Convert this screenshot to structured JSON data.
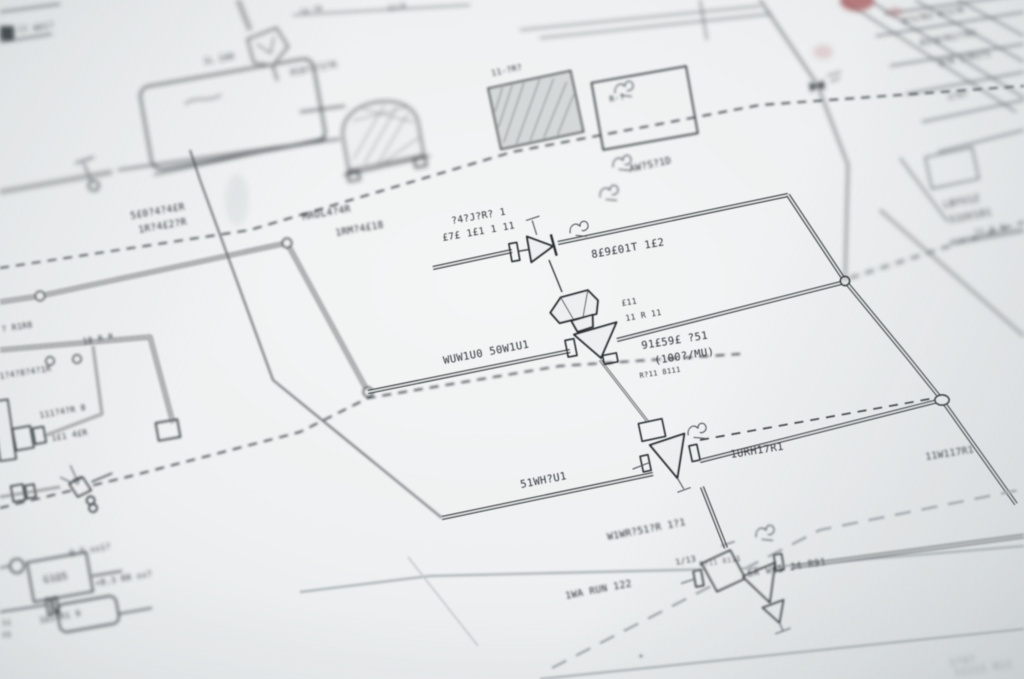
{
  "scene": {
    "description": "Close-up photograph of a paper engineering schematic (P&ID style blueprint) at a tilted angle with shallow depth of field; center valves in focus, edges blurred",
    "paper_color": "#edeff0",
    "ink_color": "#2c3034",
    "sheet_border_color": "#b3b9bb",
    "dashed_line_color": "#3b4044",
    "gray_dashed_color": "#a7adb0",
    "stamp_color": "#a86062"
  },
  "labels": [
    "1.11",
    "WH1?",
    "?4·?R",
    "11/4",
    "1L 2AR",
    "810?4?2?R",
    "11-?R?",
    "R·?",
    "AW?S?1D",
    "5£0?4?4£R",
    "1R?4£2?R",
    "MROL4?4R",
    "1RM?4£18",
    "?4?J?R? 1",
    "£7£ 1£1 1 11",
    "8£9£01T 1£2",
    "£11",
    "11 R 11",
    "WUW1U0 50W1U1",
    "91£59£ ?51",
    "(100?/MU)",
    "1URH17R1",
    "51WH?U1",
    "W1WR?51?R 1?1",
    "1/13",
    "1WA RUN 122",
    "5A W65 J4 R91",
    "11W117R1",
    "LBYV1Z",
    "51UV101",
    "?1 8.8",
    "10 R R",
    "? R1R8",
    "1?4?8?4?1R",
    "111?4?R 8",
    "1£1 4£R",
    "Q.T xx1?",
    "+8.3 RR xx?",
    "1Ω14R1 9",
    "G1Ω5",
    "11",
    "15",
    "8?1?R1 R?1?R",
    "R1?8?R1??R1",
    "8?R 1?R1?1",
    "1?4?",
    "11111 811",
    "R?11 8111",
    "xxx"
  ],
  "components": [
    "storage-vessel",
    "relief-pentagon",
    "furnace-bell",
    "hatched-exchanger",
    "equipment-box",
    "inline-valve",
    "dome-actuated-control-valve",
    "angle-valve",
    "diamond-valve-with-drain",
    "actuated-small-valve",
    "pump-unit",
    "pipe-couplings",
    "instrument-bubbles",
    "junction-nodes",
    "battery-limit-dashed-lines",
    "sheet-border-frame",
    "revision-title-block",
    "red-approval-stamp"
  ]
}
